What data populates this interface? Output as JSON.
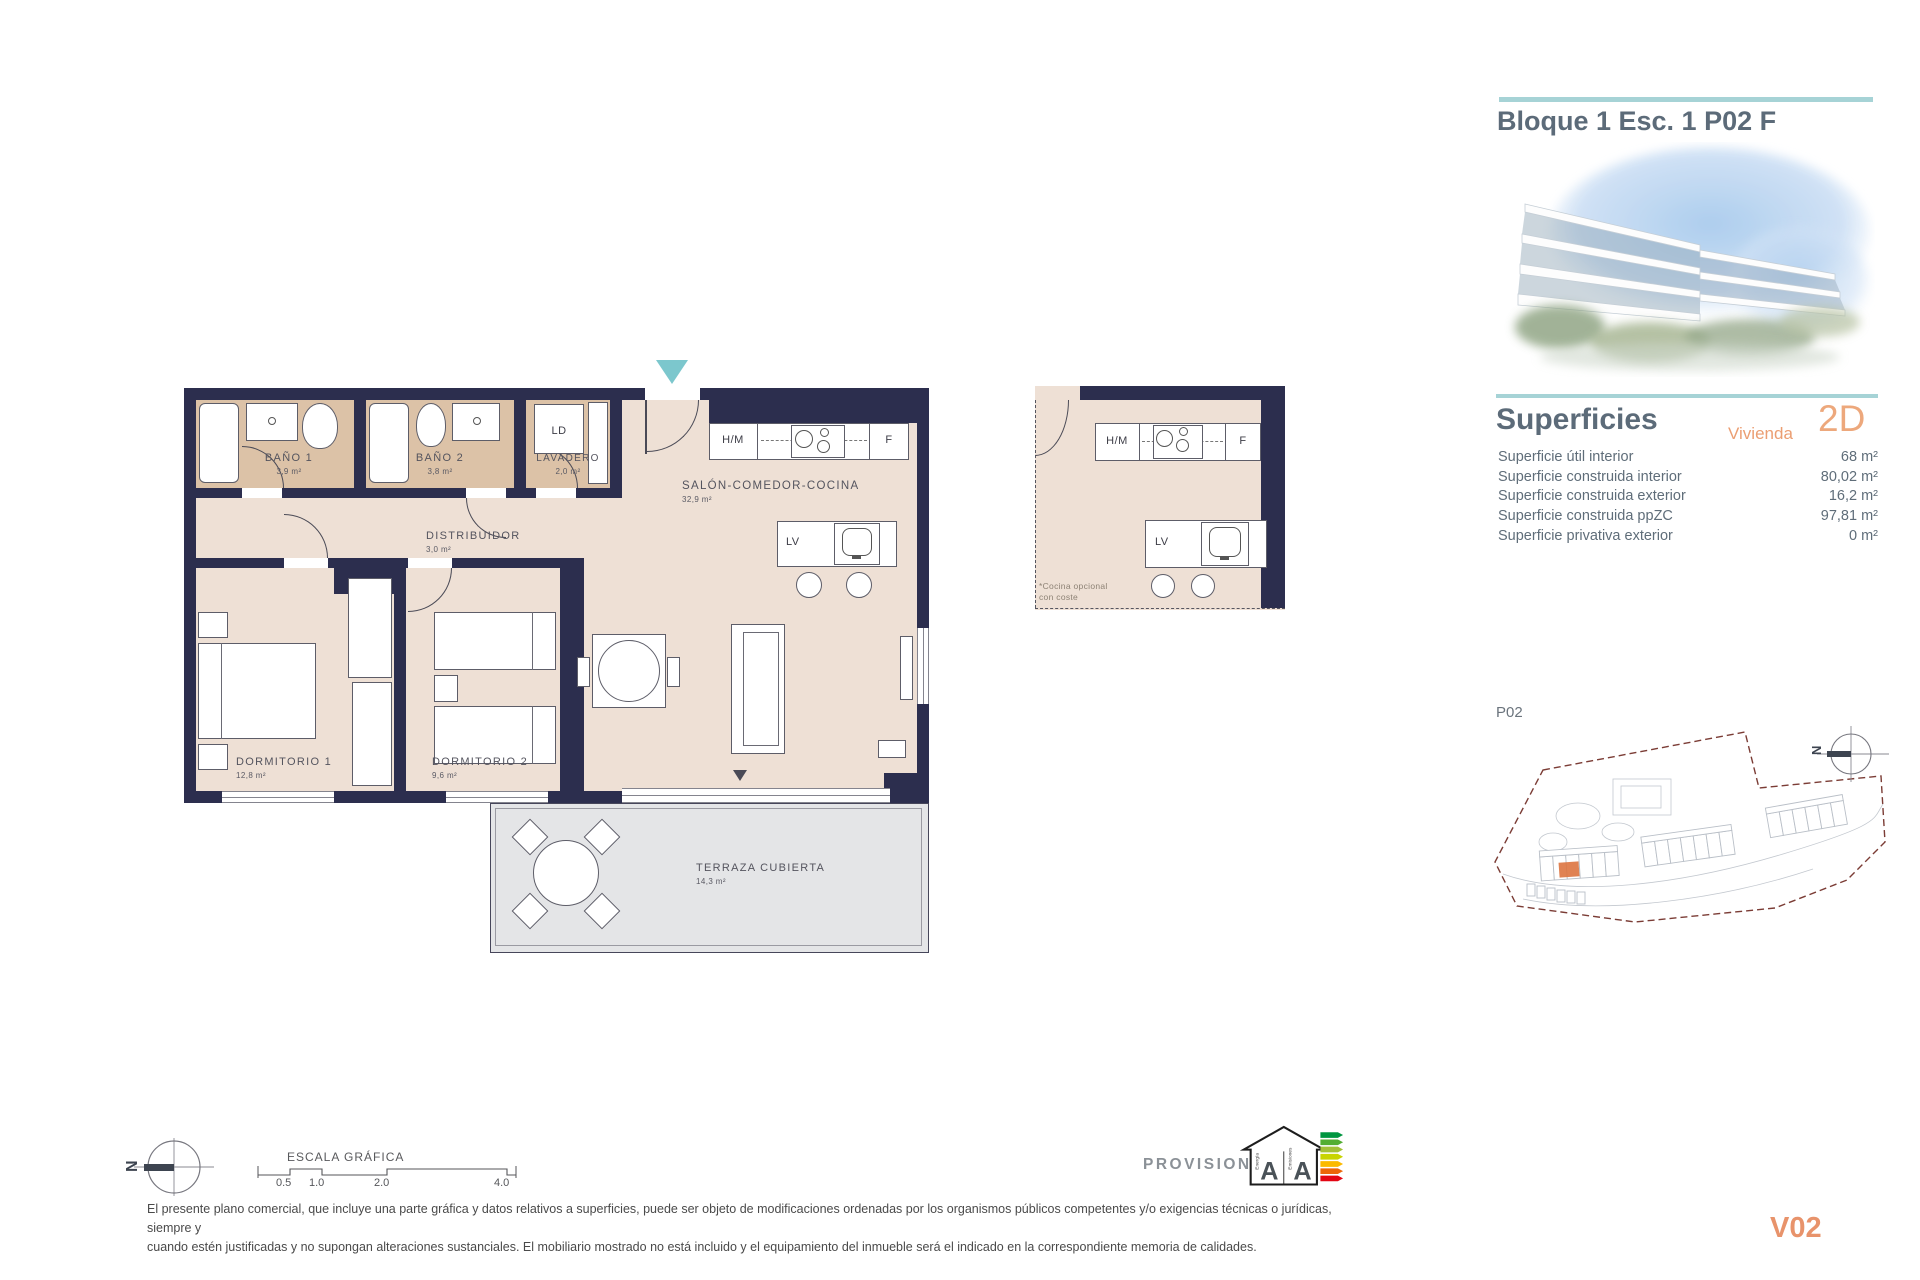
{
  "header": {
    "title": "Bloque 1 Esc. 1 P02 F"
  },
  "superficies": {
    "title": "Superficies",
    "vivienda_label": "Vivienda",
    "tipo": "2D",
    "rows": [
      {
        "label": "Superficie útil interior",
        "value": "68 m²"
      },
      {
        "label": "Superficie construida interior",
        "value": "80,02 m²"
      },
      {
        "label": "Superficie construida exterior",
        "value": "16,2 m²"
      },
      {
        "label": "Superficie construida ppZC",
        "value": "97,81 m²"
      },
      {
        "label": "Superficie privativa exterior",
        "value": "0 m²"
      }
    ]
  },
  "plan": {
    "rooms": {
      "bano1": {
        "name": "BAÑO 1",
        "area": "3,9 m²"
      },
      "bano2": {
        "name": "BAÑO 2",
        "area": "3,8 m²"
      },
      "lavadero": {
        "name": "LAVADERO",
        "area": "2,0 m²"
      },
      "distribuidor": {
        "name": "DISTRIBUIDOR",
        "area": "3,0 m²"
      },
      "salon": {
        "name": "SALÓN-COMEDOR-COCINA",
        "area": "32,9 m²"
      },
      "dorm1": {
        "name": "DORMITORIO 1",
        "area": "12,8 m²"
      },
      "dorm2": {
        "name": "DORMITORIO 2",
        "area": "9,6 m²"
      },
      "terraza": {
        "name": "TERRAZA CUBIERTA",
        "area": "14,3 m²"
      }
    },
    "labels": {
      "ld": "LD",
      "hm": "H/M",
      "f": "F",
      "lv": "LV"
    }
  },
  "kitchen_option": {
    "hm": "H/M",
    "f": "F",
    "lv": "LV",
    "note1": "*Cocina opcional",
    "note2": "con coste"
  },
  "site": {
    "level": "P02"
  },
  "compass": {
    "north": "N"
  },
  "scalebar": {
    "title": "ESCALA GRÁFICA",
    "ticks": [
      "0.5",
      "1.0",
      "2.0",
      "4.0"
    ]
  },
  "energy": {
    "status": "PROVISIONAL",
    "letter_energy": "A",
    "letter_emissions": "A",
    "axis_energy": "Energía",
    "axis_emissions": "Emisiones"
  },
  "disclaimer": {
    "line1": "El presente plano comercial, que incluye una parte gráfica y datos relativos a superficies, puede ser objeto de modificaciones ordenadas por los organismos públicos competentes y/o exigencias técnicas o jurídicas, siempre y",
    "line2": "cuando estén justificadas y no supongan alteraciones sustanciales. El mobiliario mostrado no está incluido y el equipamiento del inmueble será el indicado en la correspondiente memoria de calidades."
  },
  "version": "V02",
  "colors": {
    "accent_teal": "#a6d3d6",
    "accent_orange": "#e8936b",
    "wall": "#2c2e4e",
    "floor_main": "#eee0d5",
    "floor_wet": "#dcc2a7",
    "floor_terrace": "#e4e5e7",
    "heading": "#5c6b79",
    "site_boundary": "#7b3c35"
  }
}
